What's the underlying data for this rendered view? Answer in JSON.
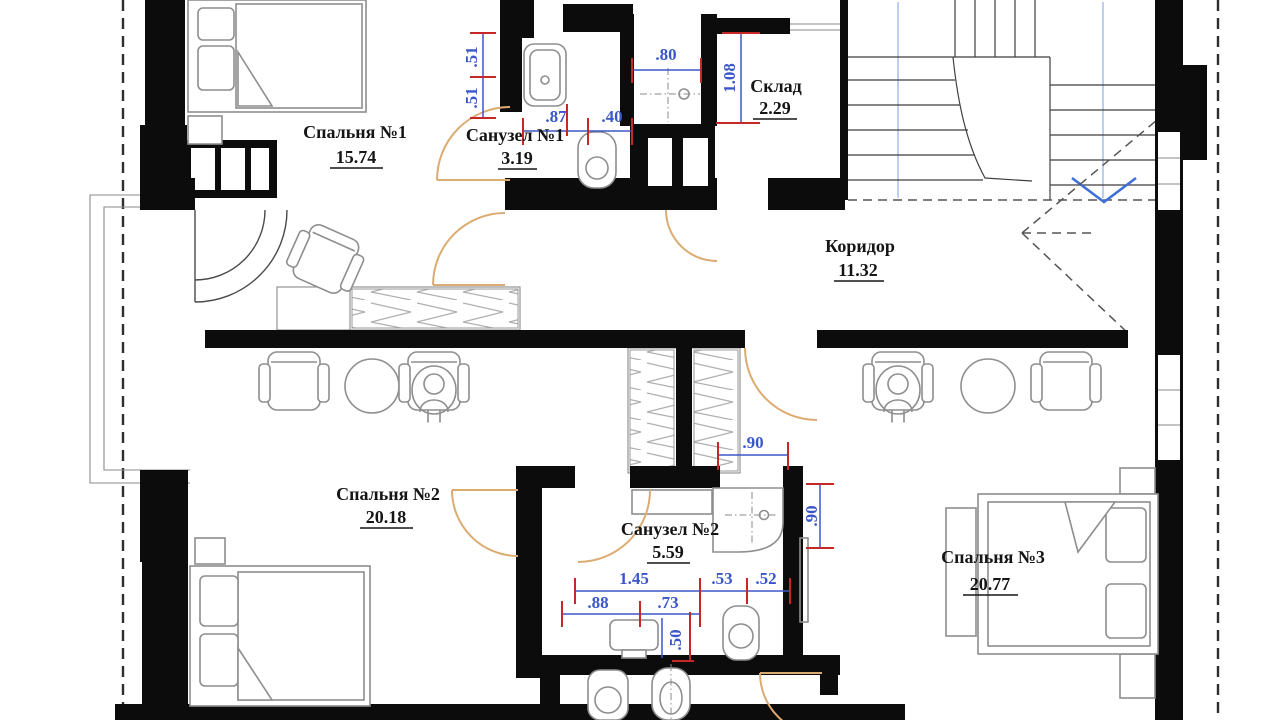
{
  "plan": {
    "rooms": [
      {
        "name": "Спальня №1",
        "area": "15.74"
      },
      {
        "name": "Санузел №1",
        "area": "3.19"
      },
      {
        "name": "Склад",
        "area": "2.29"
      },
      {
        "name": "Коридор",
        "area": "11.32"
      },
      {
        "name": "Спальня №2",
        "area": "20.18"
      },
      {
        "name": "Санузел №2",
        "area": "5.59"
      },
      {
        "name": "Спальня №3",
        "area": "20.77"
      }
    ],
    "dims": {
      "v51a": ".51",
      "v51b": ".51",
      "w87": ".87",
      "w40": ".40",
      "w80": ".80",
      "h108": "1.08",
      "w90": ".90",
      "h90": ".90",
      "w145": "1.45",
      "w53": ".53",
      "w52": ".52",
      "w88": ".88",
      "w73": ".73",
      "h50": ".50"
    },
    "colors": {
      "wall": "#0c0c0c",
      "dimension": "#3a56c8",
      "tick": "#c62828",
      "door": "#dcab72",
      "furniture": "#8e8e8e",
      "stair_arrow": "#3f6fd8"
    }
  }
}
